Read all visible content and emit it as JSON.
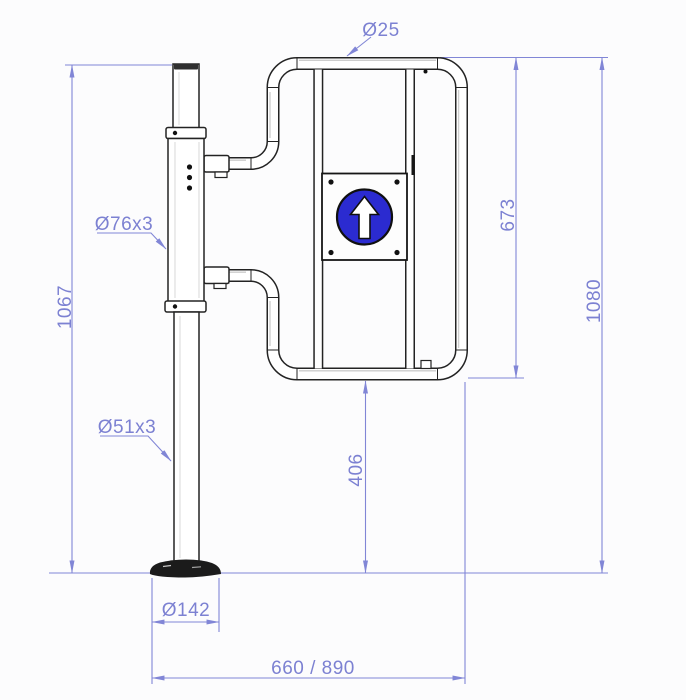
{
  "drawing": {
    "title": "Swing gate with post - dimensioned technical drawing",
    "sign": {
      "name": "one-way-up-arrow",
      "color": "#2b2bd0"
    },
    "colors": {
      "dimension": "#7c81d2",
      "outline": "#232323",
      "background": "#fcfcfd",
      "sign_blue": "#2b2bd0"
    },
    "dimensions": {
      "frame_tube": "Ø25",
      "gate_height": "673",
      "overall_height": "1080",
      "post_height": "1067",
      "housing_tube": "Ø76x3",
      "post_tube": "Ø51x3",
      "bottom_clearance": "406",
      "base_flange": "Ø142",
      "overall_width": "660 / 890"
    }
  }
}
